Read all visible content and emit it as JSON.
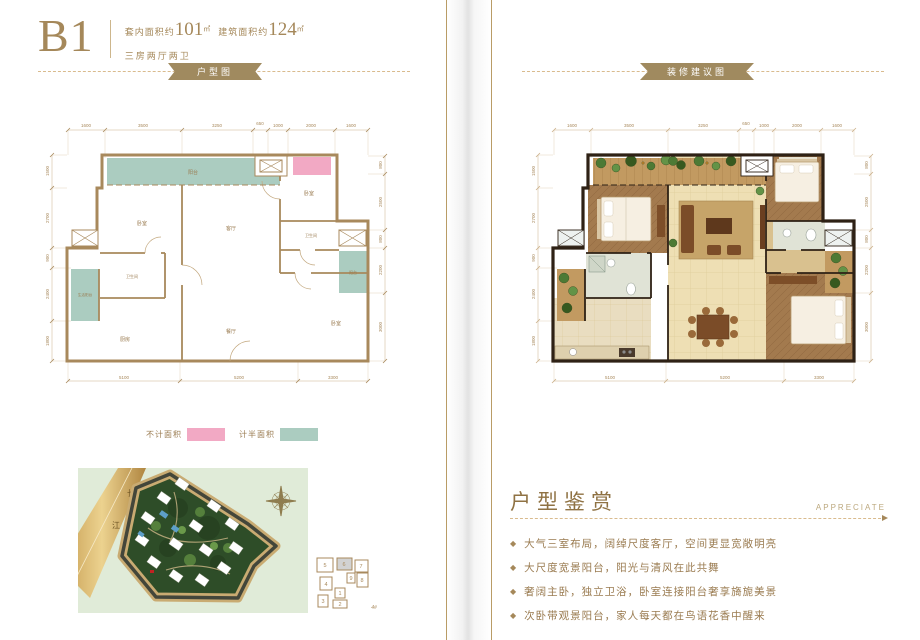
{
  "header": {
    "unit_code": "B1",
    "inner_area_label": "套内面积约",
    "inner_area_value": "101",
    "inner_area_unit": "㎡",
    "build_area_label": "建筑面积约",
    "build_area_value": "124",
    "build_area_unit": "㎡",
    "layout_desc": "三房两厅两卫"
  },
  "ribbons": {
    "left": "户型图",
    "right": "装修建议图"
  },
  "floorplan": {
    "labels": [
      "阳台",
      "卧室",
      "客厅",
      "卧室",
      "卫生间",
      "卫生间",
      "生活阳台",
      "阳台",
      "餐厅",
      "厨房",
      "卧室"
    ],
    "dims_top": [
      "1600",
      "3500",
      "3250",
      "650",
      "1000",
      "2000",
      "1600"
    ],
    "dims_bottom": [
      "5100",
      "5200",
      "3300"
    ],
    "dims_left": [
      "1500",
      "2700",
      "900",
      "2400",
      "1800"
    ],
    "dims_right": [
      "800",
      "2500",
      "800",
      "2200",
      "3000"
    ]
  },
  "legend": {
    "items": [
      {
        "label": "不计面积",
        "color": "#f2a9c4"
      },
      {
        "label": "计半面积",
        "color": "#abccc0"
      }
    ]
  },
  "siteplan": {
    "river_char_1": "长",
    "river_char_2": "江",
    "keyplan": {
      "units": [
        "5",
        "6",
        "7",
        "4",
        "9",
        "8",
        "1",
        "3",
        "2"
      ],
      "highlighted_unit": "6",
      "building_label": "4#"
    }
  },
  "appreciation": {
    "title": "户型鉴赏",
    "subtitle": "APPRECIATE",
    "bullets": [
      {
        "text": "大气三室布局，阔绰尺度客厅，空间更显宽敞明亮"
      },
      {
        "text": "大尺度宽景阳台，阳光与清风在此共舞"
      },
      {
        "text": "奢阔主卧，独立卫浴，卧室连接阳台奢享旖旎美景"
      },
      {
        "text": "次卧带观景阳台，家人每天都在鸟语花香中醒来"
      }
    ]
  },
  "colors": {
    "accent_gold": "#a5885a",
    "ribbon": "#a08a5f",
    "no_area_pink": "#f2a9c4",
    "half_area_teal": "#abccc0",
    "wall_tan": "#a8895c",
    "wall_dark": "#2e2115"
  }
}
